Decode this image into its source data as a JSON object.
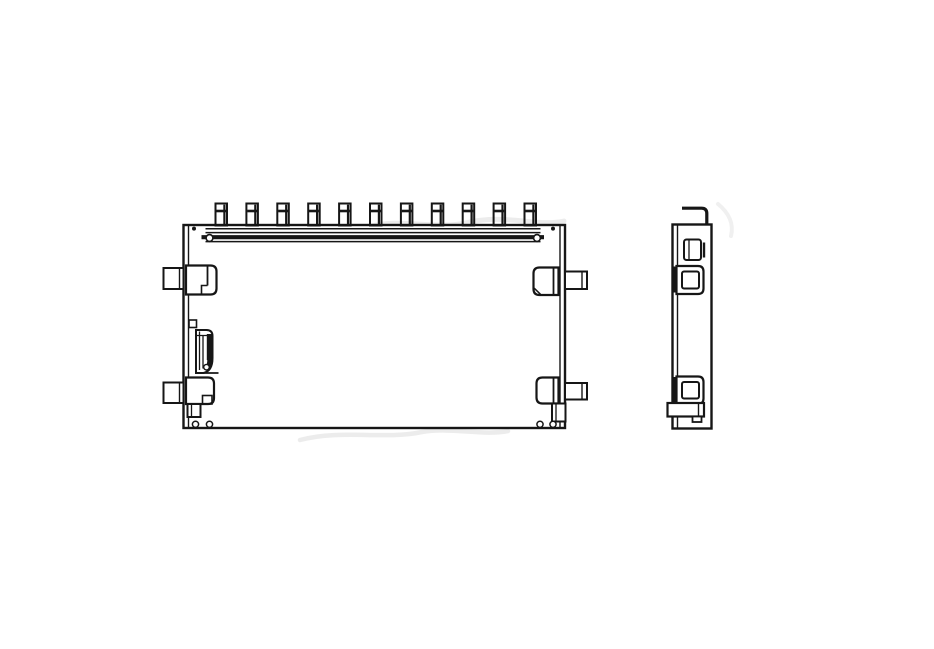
{
  "canvas": {
    "width": 934,
    "height": 649,
    "background": "#ffffff",
    "line_color": "#161616",
    "watermark_color": "#d9d9d9"
  },
  "drawing": {
    "kind": "technical-line-drawing",
    "subject": "surface-mount card connector, orthographic front and side views, no dimension text",
    "watermark": {
      "visible": true,
      "legible": false
    },
    "views": [
      {
        "id": "watermark-layer"
      },
      {
        "id": "front-view"
      },
      {
        "id": "side-view"
      }
    ],
    "pins": {
      "count": 11,
      "x_start": 215.5,
      "pitch": 30.9,
      "width": 11.5,
      "y_top": 203.5,
      "y_bottom": 225.5,
      "cap_offset": 7.5
    },
    "shapes": [
      {
        "view": "watermark-layer",
        "name": "watermark-smudge-1",
        "kind": "path",
        "d": "M253,252 C292,224 332,238 368,227 C402,217 432,231 470,222 C505,214 538,227 564,221",
        "stroke": "wm",
        "sw": 5,
        "opacity": 0.5,
        "cap": "round"
      },
      {
        "view": "watermark-layer",
        "name": "watermark-smudge-2",
        "kind": "path",
        "d": "M300,440 C342,429 384,440 422,432 C452,427 482,436 508,431",
        "stroke": "wm",
        "sw": 4.5,
        "opacity": 0.5,
        "cap": "round"
      },
      {
        "view": "watermark-layer",
        "name": "watermark-smudge-3",
        "kind": "path",
        "d": "M718,204 C729,213 734,224 731,236",
        "stroke": "wm",
        "sw": 4,
        "opacity": 0.4,
        "cap": "round"
      },
      {
        "view": "front-view",
        "name": "body-outline",
        "kind": "rect",
        "x": 183.5,
        "y": 225,
        "w": 381.5,
        "h": 203,
        "sw": 2.4,
        "fill": "white"
      },
      {
        "view": "front-view",
        "name": "body-left-inner-wall",
        "kind": "line",
        "x1": 188.5,
        "y1": 225.5,
        "x2": 188.5,
        "y2": 427.5,
        "sw": 1.4
      },
      {
        "view": "front-view",
        "name": "body-right-inner-wall",
        "kind": "line",
        "x1": 560,
        "y1": 225.5,
        "x2": 560,
        "y2": 427.5,
        "sw": 1.4
      },
      {
        "view": "front-view",
        "name": "rail-line-1",
        "kind": "line",
        "x1": 205.5,
        "y1": 228.8,
        "x2": 540.5,
        "y2": 228.8,
        "sw": 1.5
      },
      {
        "view": "front-view",
        "name": "rail-line-2",
        "kind": "line",
        "x1": 205.5,
        "y1": 232.6,
        "x2": 540.5,
        "y2": 232.6,
        "sw": 1.5
      },
      {
        "view": "front-view",
        "name": "rail-band",
        "kind": "line",
        "x1": 201.5,
        "y1": 237.2,
        "x2": 544,
        "y2": 237.2,
        "sw": 4.2
      },
      {
        "view": "front-view",
        "name": "rail-line-3",
        "kind": "line",
        "x1": 205.5,
        "y1": 241.6,
        "x2": 540.5,
        "y2": 241.6,
        "sw": 1.5
      },
      {
        "view": "front-view",
        "name": "rail-end-left",
        "kind": "circle",
        "cx": 209.5,
        "cy": 238,
        "r": 3.4,
        "sw": 1.6,
        "fill": "white"
      },
      {
        "view": "front-view",
        "name": "rail-end-right",
        "kind": "circle",
        "cx": 537,
        "cy": 238,
        "r": 3.4,
        "sw": 1.6,
        "fill": "white"
      },
      {
        "view": "front-view",
        "name": "corner-rivet-left",
        "kind": "circle",
        "cx": 194,
        "cy": 228.6,
        "r": 2,
        "fill": "ink",
        "stroke": "none",
        "sw": 0
      },
      {
        "view": "front-view",
        "name": "corner-rivet-right",
        "kind": "circle",
        "cx": 553,
        "cy": 228.6,
        "r": 2,
        "fill": "ink",
        "stroke": "none",
        "sw": 0
      },
      {
        "view": "front-view",
        "name": "left-top-lug",
        "kind": "rect",
        "x": 163.5,
        "y": 268,
        "w": 20,
        "h": 21,
        "sw": 2,
        "fill": "white"
      },
      {
        "view": "front-view",
        "name": "left-top-lug-divider",
        "kind": "line",
        "x1": 179.5,
        "y1": 268,
        "x2": 179.5,
        "y2": 289,
        "sw": 1.4
      },
      {
        "view": "front-view",
        "name": "left-top-bracket",
        "kind": "path",
        "d": "M186,265.5 h24.5 q6,0 6,6 v17 q0,6 -6,6 h-24.5 z",
        "sw": 2.2,
        "fill": "white"
      },
      {
        "view": "front-view",
        "name": "left-top-bracket-divider",
        "kind": "line",
        "x1": 207.5,
        "y1": 266,
        "x2": 207.5,
        "y2": 285.5,
        "sw": 1.8
      },
      {
        "view": "front-view",
        "name": "left-top-bracket-step",
        "kind": "path",
        "d": "M207.5,285.5 h-6 v8.5",
        "sw": 1.6
      },
      {
        "view": "front-view",
        "name": "latch-mount",
        "kind": "rect",
        "x": 189,
        "y": 320,
        "w": 7.5,
        "h": 7.5,
        "sw": 1.6
      },
      {
        "view": "front-view",
        "name": "latch-outline",
        "kind": "path",
        "d": "M196,330 h10.5 q6,0 6,6 v22 q0,13 -9,15 h-7.5 z",
        "sw": 2,
        "fill": "white"
      },
      {
        "view": "front-view",
        "name": "latch-top-line",
        "kind": "line",
        "x1": 196,
        "y1": 335.5,
        "x2": 212.5,
        "y2": 335.5,
        "sw": 1.3
      },
      {
        "view": "front-view",
        "name": "latch-spring-line-1",
        "kind": "line",
        "x1": 199.5,
        "y1": 331.5,
        "x2": 199.5,
        "y2": 370,
        "sw": 1.3
      },
      {
        "view": "front-view",
        "name": "latch-spring-line-2",
        "kind": "line",
        "x1": 203,
        "y1": 335.5,
        "x2": 203,
        "y2": 368.5,
        "sw": 1.3
      },
      {
        "view": "front-view",
        "name": "latch-dark-band",
        "kind": "line",
        "x1": 209.3,
        "y1": 334,
        "x2": 209.3,
        "y2": 360,
        "sw": 5
      },
      {
        "view": "front-view",
        "name": "latch-hook-curve",
        "kind": "path",
        "d": "M209.3,358 q1.5,8 -4,10.5",
        "sw": 4.6
      },
      {
        "view": "front-view",
        "name": "latch-hook-eye",
        "kind": "circle",
        "cx": 206.5,
        "cy": 367.2,
        "r": 2.8,
        "sw": 1.4,
        "fill": "white"
      },
      {
        "view": "front-view",
        "name": "latch-base-line",
        "kind": "line",
        "x1": 196,
        "y1": 373,
        "x2": 218.5,
        "y2": 373,
        "sw": 1.8
      },
      {
        "view": "front-view",
        "name": "left-bottom-lug",
        "kind": "rect",
        "x": 163.5,
        "y": 382.5,
        "w": 20,
        "h": 20.5,
        "sw": 2,
        "fill": "white"
      },
      {
        "view": "front-view",
        "name": "left-bottom-lug-divider",
        "kind": "line",
        "x1": 179.5,
        "y1": 382.5,
        "x2": 179.5,
        "y2": 403,
        "sw": 1.4
      },
      {
        "view": "front-view",
        "name": "left-bottom-bracket",
        "kind": "path",
        "d": "M186,377.5 h22 q6,0 6,6 v14.5 q0,6 -6,6 h-22 z",
        "sw": 2.2,
        "fill": "white"
      },
      {
        "view": "front-view",
        "name": "left-bottom-bracket-notch",
        "kind": "rect",
        "x": 202.5,
        "y": 395.5,
        "w": 9.5,
        "h": 8.5,
        "sw": 1.6
      },
      {
        "view": "front-view",
        "name": "left-bottom-foot",
        "kind": "rect",
        "x": 187.5,
        "y": 404,
        "w": 13,
        "h": 13,
        "sw": 2,
        "fill": "white"
      },
      {
        "view": "front-view",
        "name": "left-bottom-foot-divider",
        "kind": "line",
        "x1": 191.5,
        "y1": 404,
        "x2": 191.5,
        "y2": 417,
        "sw": 1.3
      },
      {
        "view": "front-view",
        "name": "left-solder-pad-1",
        "kind": "circle",
        "cx": 195.5,
        "cy": 424.3,
        "r": 3.1,
        "sw": 1.5,
        "fill": "white"
      },
      {
        "view": "front-view",
        "name": "left-solder-pad-2",
        "kind": "circle",
        "cx": 209.5,
        "cy": 424.3,
        "r": 3.1,
        "sw": 1.5,
        "fill": "white"
      },
      {
        "view": "front-view",
        "name": "right-top-bracket",
        "kind": "path",
        "d": "M558.5,267.5 h-19 q-6,0 -6,6 v15.5 q0,6 6,6 h19 z",
        "sw": 2.2,
        "fill": "white"
      },
      {
        "view": "front-view",
        "name": "right-top-bracket-divider",
        "kind": "line",
        "x1": 553.5,
        "y1": 268,
        "x2": 553.5,
        "y2": 294.5,
        "sw": 1.8
      },
      {
        "view": "front-view",
        "name": "right-top-bracket-chamfer",
        "kind": "line",
        "x1": 534.2,
        "y1": 288.2,
        "x2": 540.5,
        "y2": 294.3,
        "sw": 1.5
      },
      {
        "view": "front-view",
        "name": "right-top-lug",
        "kind": "rect",
        "x": 565,
        "y": 271.5,
        "w": 22,
        "h": 17.5,
        "sw": 2,
        "fill": "white"
      },
      {
        "view": "front-view",
        "name": "right-top-lug-divider",
        "kind": "line",
        "x1": 582,
        "y1": 271.5,
        "x2": 582,
        "y2": 289,
        "sw": 1.4
      },
      {
        "view": "front-view",
        "name": "right-bottom-bracket",
        "kind": "path",
        "d": "M558.5,377.5 h-16 q-6,0 -6,6 v14 q0,6 6,6 h16 z",
        "sw": 2.2,
        "fill": "white"
      },
      {
        "view": "front-view",
        "name": "right-bottom-bracket-divider",
        "kind": "line",
        "x1": 553.5,
        "y1": 378,
        "x2": 553.5,
        "y2": 403,
        "sw": 1.8
      },
      {
        "view": "front-view",
        "name": "right-bottom-lug",
        "kind": "rect",
        "x": 565,
        "y": 383,
        "w": 22,
        "h": 16.5,
        "sw": 2,
        "fill": "white"
      },
      {
        "view": "front-view",
        "name": "right-bottom-lug-divider",
        "kind": "line",
        "x1": 582,
        "y1": 383,
        "x2": 582,
        "y2": 399.5,
        "sw": 1.4
      },
      {
        "view": "front-view",
        "name": "right-bottom-foot",
        "kind": "rect",
        "x": 552,
        "y": 403.5,
        "w": 13.5,
        "h": 18,
        "sw": 2,
        "fill": "white"
      },
      {
        "view": "front-view",
        "name": "right-bottom-foot-divider",
        "kind": "line",
        "x1": 556,
        "y1": 403.5,
        "x2": 556,
        "y2": 421.5,
        "sw": 1.3
      },
      {
        "view": "front-view",
        "name": "right-solder-pad-1",
        "kind": "circle",
        "cx": 540,
        "cy": 424.3,
        "r": 3.1,
        "sw": 1.5,
        "fill": "white"
      },
      {
        "view": "front-view",
        "name": "right-solder-pad-2",
        "kind": "circle",
        "cx": 553,
        "cy": 424.3,
        "r": 3.1,
        "sw": 1.5,
        "fill": "white"
      },
      {
        "view": "side-view",
        "name": "side-hook-pin",
        "kind": "path",
        "d": "M682,208.2 L701.5,208.2 Q706.8,208.2 706.8,213.5 L706.8,225",
        "sw": 3.2
      },
      {
        "view": "side-view",
        "name": "side-body-outline",
        "kind": "rect",
        "x": 672.5,
        "y": 224.5,
        "w": 39,
        "h": 204,
        "sw": 2.4,
        "fill": "white"
      },
      {
        "view": "side-view",
        "name": "side-left-inner-wall",
        "kind": "line",
        "x1": 677.5,
        "y1": 225,
        "x2": 677.5,
        "y2": 428,
        "sw": 1.4
      },
      {
        "view": "side-view",
        "name": "side-top-slot",
        "kind": "rect",
        "x": 684,
        "y": 239.5,
        "w": 17,
        "h": 20.5,
        "rx": 2.5,
        "sw": 2
      },
      {
        "view": "side-view",
        "name": "side-top-slot-divider",
        "kind": "line",
        "x1": 689,
        "y1": 240,
        "x2": 689,
        "y2": 259.5,
        "sw": 1.3
      },
      {
        "view": "side-view",
        "name": "side-top-slot-edge",
        "kind": "line",
        "x1": 704,
        "y1": 242.5,
        "x2": 704,
        "y2": 257.5,
        "sw": 2.4
      },
      {
        "view": "side-view",
        "name": "side-wall-fill-upper",
        "kind": "rect",
        "x": 672.5,
        "y": 266.5,
        "w": 5,
        "h": 26,
        "fill": "ink",
        "stroke": "none",
        "sw": 0
      },
      {
        "view": "side-view",
        "name": "side-upper-bracket",
        "kind": "path",
        "d": "M676.5,266 h21.5 q5.5,0 5.5,5.5 v17 q0,5.5 -5.5,5.5 h-21.5 z",
        "sw": 2.2,
        "fill": "white"
      },
      {
        "view": "side-view",
        "name": "side-upper-bracket-inner",
        "kind": "rect",
        "x": 682,
        "y": 271.5,
        "w": 17,
        "h": 17,
        "rx": 2,
        "sw": 2
      },
      {
        "view": "side-view",
        "name": "side-wall-fill-lower",
        "kind": "rect",
        "x": 672.5,
        "y": 377,
        "w": 5,
        "h": 26,
        "fill": "ink",
        "stroke": "none",
        "sw": 0
      },
      {
        "view": "side-view",
        "name": "side-lower-bracket",
        "kind": "path",
        "d": "M676.5,376.5 h21.5 q5.5,0 5.5,5.5 v16.5 q0,5.5 -5.5,5.5 h-21.5 z",
        "sw": 2.2,
        "fill": "white"
      },
      {
        "view": "side-view",
        "name": "side-lower-bracket-inner",
        "kind": "rect",
        "x": 682,
        "y": 382,
        "w": 17,
        "h": 16.5,
        "rx": 2,
        "sw": 2
      },
      {
        "view": "side-view",
        "name": "side-bottom-tab",
        "kind": "rect",
        "x": 667.5,
        "y": 403,
        "w": 36.5,
        "h": 13.5,
        "sw": 2.2,
        "fill": "white"
      },
      {
        "view": "side-view",
        "name": "side-bottom-tab-divider",
        "kind": "line",
        "x1": 698.5,
        "y1": 403,
        "x2": 698.5,
        "y2": 416.5,
        "sw": 1.4
      },
      {
        "view": "side-view",
        "name": "side-bottom-foot",
        "kind": "rect",
        "x": 692.5,
        "y": 416.5,
        "w": 9,
        "h": 5.5,
        "sw": 1.8,
        "fill": "white"
      }
    ]
  }
}
